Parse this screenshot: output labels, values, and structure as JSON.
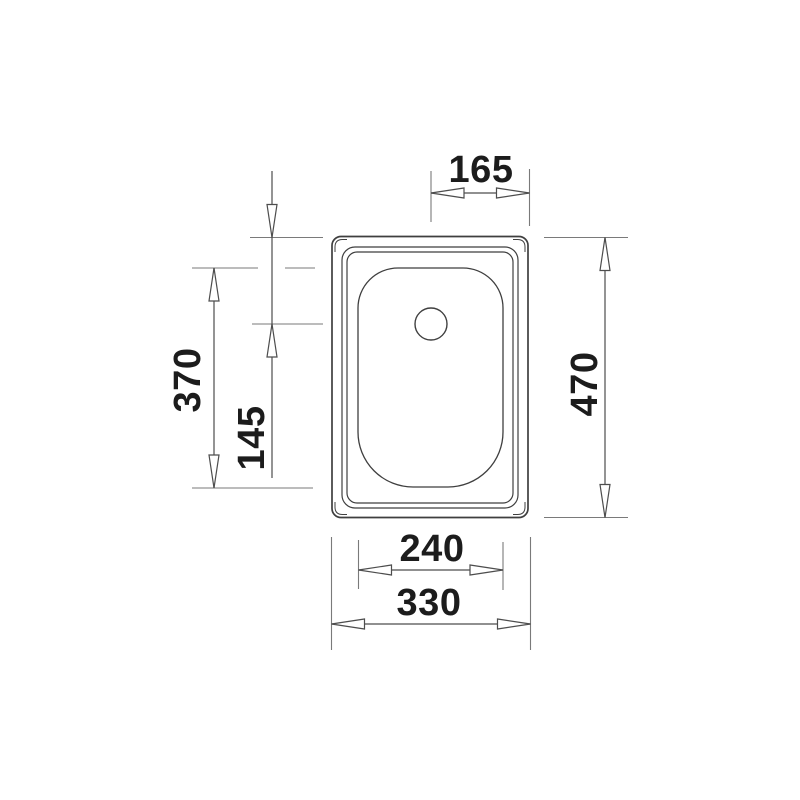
{
  "diagram": {
    "kind": "technical-drawing",
    "subject": "kitchen sink top view with dimension lines",
    "colors": {
      "background": "#ffffff",
      "drawing_line": "#3f3f3f",
      "extension_line": "#7a7a7a",
      "dimension_line": "#4d4d4d",
      "text": "#1c1c1c"
    },
    "dimensions": {
      "drain_to_right_edge": "165",
      "overall_length": "470",
      "bowl_length": "370",
      "top_edge_to_drain": "145",
      "bowl_width": "240",
      "overall_width": "330"
    }
  }
}
